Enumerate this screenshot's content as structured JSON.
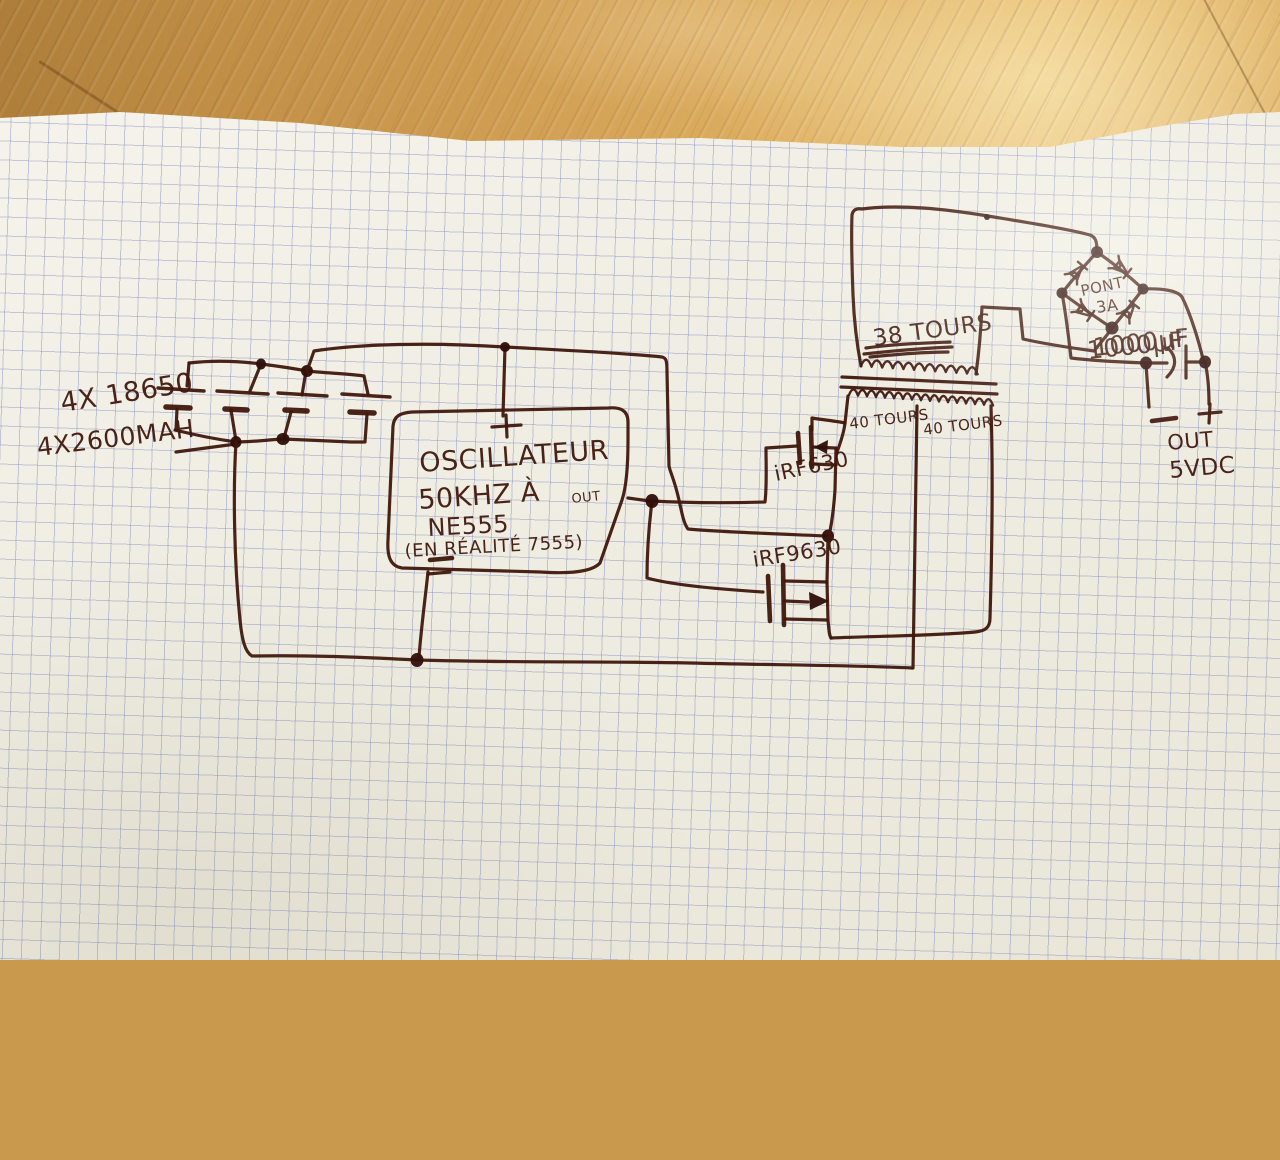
{
  "scene_colors": {
    "ink": "#3f170c",
    "paper": "#f0eee3",
    "grid_line": "#7a84be",
    "wood": "#cf9d52"
  },
  "battery": {
    "line1": "4X 18650",
    "line2": "4X2600MAH"
  },
  "oscillator": {
    "plus_sign": "+",
    "minus_sign": "−",
    "line1": "OSCILLATEUR",
    "line2": "50KHZ À",
    "out_label": "OUT",
    "line3": "NE555",
    "line4": "(EN RÉALITÉ 7555)"
  },
  "mosfets": {
    "top": "iRF630",
    "bottom": "iRF9630"
  },
  "transformer": {
    "secondary": "38 TOURS",
    "primary_left": "40 TOURS",
    "primary_right": "40 TOURS"
  },
  "bridge": {
    "line1": "PONT",
    "line2": "3A"
  },
  "capacitor": {
    "value": "1000µF"
  },
  "output": {
    "minus_sign": "−",
    "plus_sign": "+",
    "line1": "OUT",
    "line2": "5VDC"
  }
}
